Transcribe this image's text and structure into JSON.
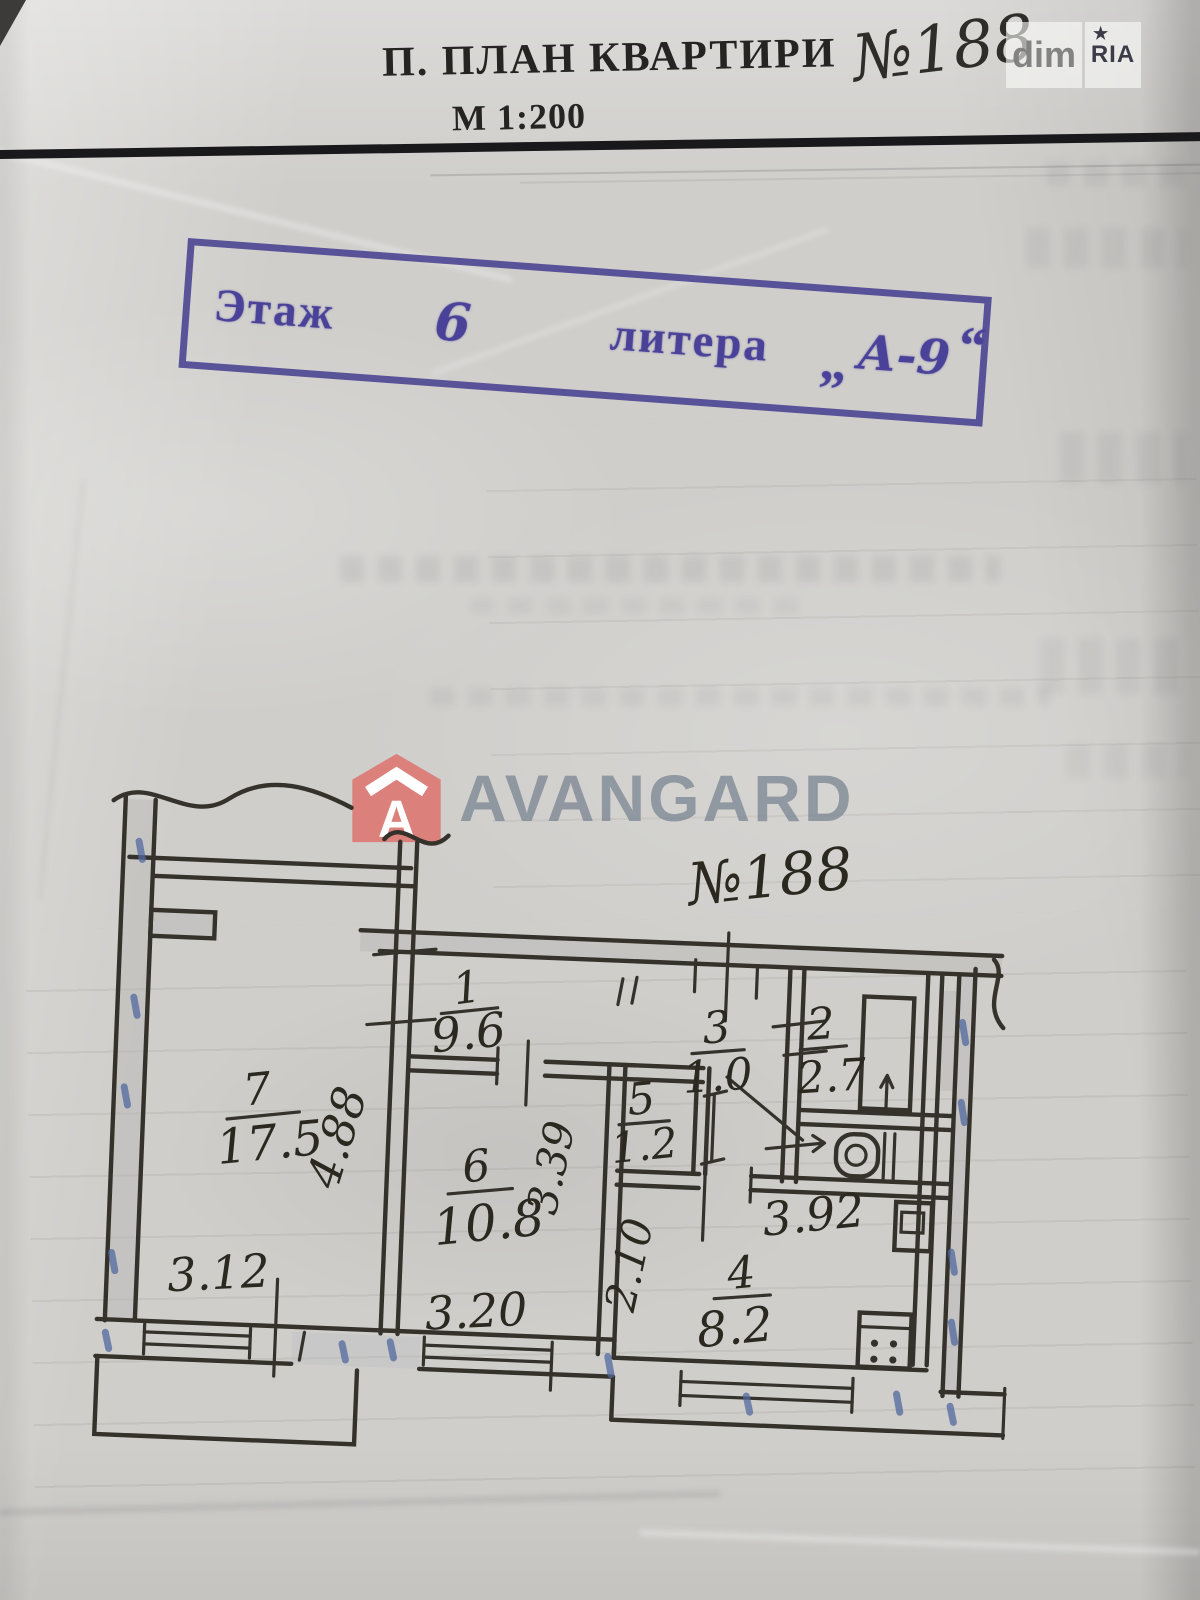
{
  "header": {
    "title": "П. ПЛАН КВАРТИРИ",
    "apartment_no": "№188",
    "scale": "М 1:200"
  },
  "stamp": {
    "floor_label": "Этаж",
    "floor_value": "6",
    "litera_label": "литера",
    "quote_open": "„",
    "litera_value": "А-9",
    "quote_close": "“"
  },
  "watermarks": {
    "avangard": "AVANGARD",
    "avangard_icon_letter": "A",
    "dim": "dim",
    "ria": "RIA",
    "ria_star": "★"
  },
  "plan": {
    "apartment_no": "№188",
    "rooms": [
      {
        "number": "1",
        "area": "9.6"
      },
      {
        "number": "2",
        "area": "2.7"
      },
      {
        "number": "3",
        "area": "1.0"
      },
      {
        "number": "4",
        "area": "8.2"
      },
      {
        "number": "5",
        "area": "1.2"
      },
      {
        "number": "6",
        "area": "10.8"
      },
      {
        "number": "7",
        "area": "17.5"
      }
    ],
    "dimensions": [
      {
        "value": "4.88"
      },
      {
        "value": "3.12"
      },
      {
        "value": "3.20"
      },
      {
        "value": "3.39"
      },
      {
        "value": "2.10"
      },
      {
        "value": "3.92"
      }
    ]
  }
}
